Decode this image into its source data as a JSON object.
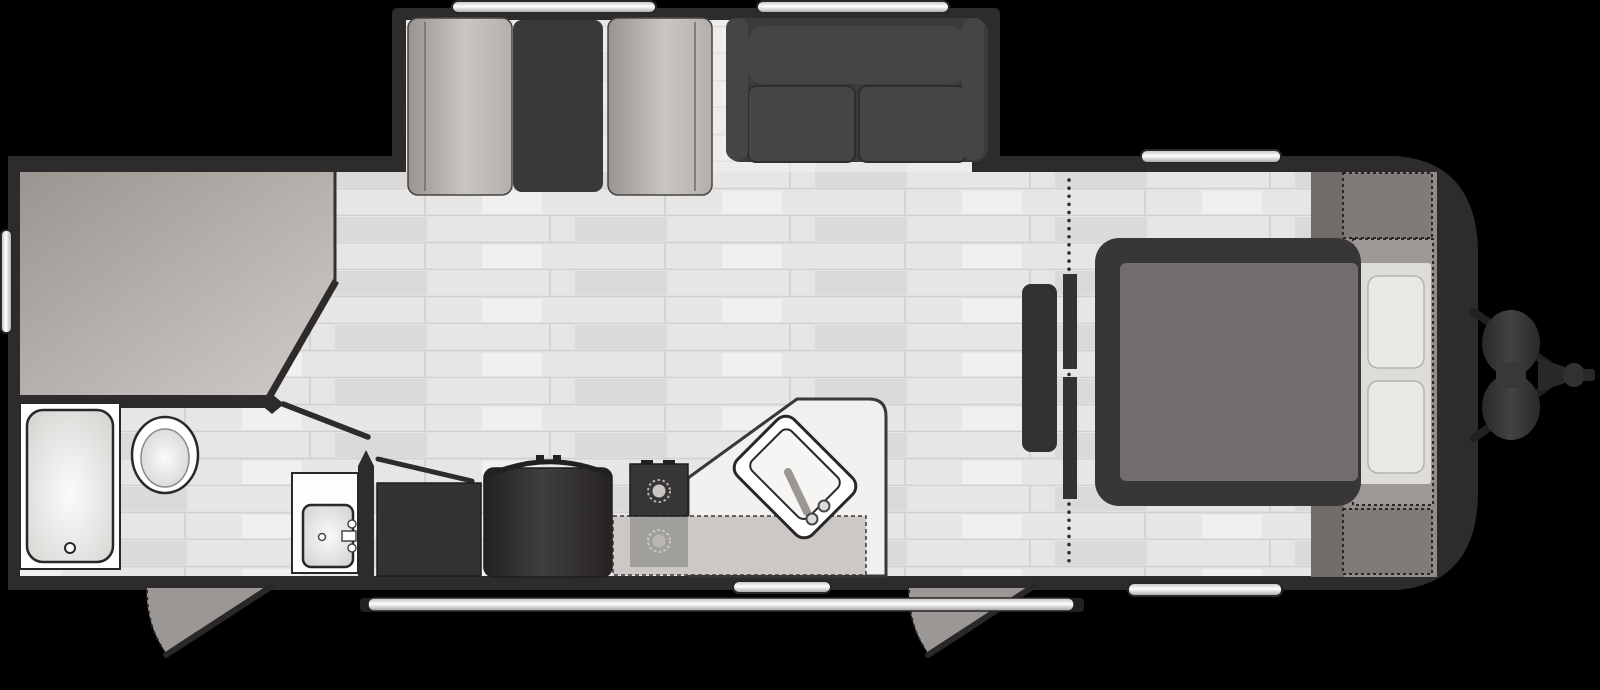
{
  "floorplan": {
    "vehicle": "travel-trailer",
    "view": "top-down",
    "slide_out_count": 1,
    "entry_door_count": 2,
    "window_count": 5,
    "rooms": [
      "rear-bunk-room",
      "bathroom",
      "kitchen-living-area",
      "bedroom",
      "front-pass-through-storage"
    ],
    "fixtures": [
      "bunk-beds",
      "shower",
      "toilet",
      "bathroom-vanity-sink",
      "bathroom-door",
      "closet-door",
      "wardrobe-cabinet",
      "refrigerator",
      "range-cooktop",
      "kitchen-counter",
      "kitchen-sink",
      "counter-extension",
      "dinette-bench-left",
      "dinette-table",
      "dinette-bench-right",
      "sofa",
      "tv",
      "bedroom-dresser",
      "bed",
      "pillows",
      "privacy-curtain",
      "front-wardrobe-top",
      "front-wardrobe-bottom",
      "bed-head-storage",
      "entry-door-rear",
      "entry-door-front",
      "grab-handle",
      "awning-rail",
      "window-slideout-left",
      "window-slideout-right",
      "window-roadside",
      "window-bedroom",
      "window-rear",
      "propane-tanks",
      "a-frame-tongue",
      "hitch-coupler"
    ]
  },
  "colors": {
    "background": "#000000",
    "wall": "#2e2b2c",
    "wall_dark": "#232021",
    "floor": "#e7e6e4",
    "slideout_floor": "#edecea",
    "front_area": "#8f8c8a",
    "front_band": "#6f6c6a",
    "front_cabinet": "#7e7b79",
    "bed_head_area": "#9c9996",
    "pillow_panel": "#dedcd9",
    "pillow": "#eae8e5",
    "bed_frame": "#393637",
    "mattress": "#716e6d",
    "cabinet": "#343132",
    "dinette_table": "#3b3839",
    "sofa": "#3d3a3b",
    "sofa_cushion": "#474445",
    "counter": "#f1f0ee",
    "counter_extension": "#cbc8c5",
    "range": "#383536",
    "door_swing": "#9a9794",
    "curtain": "#2e2b2c",
    "white": "#ffffff"
  }
}
